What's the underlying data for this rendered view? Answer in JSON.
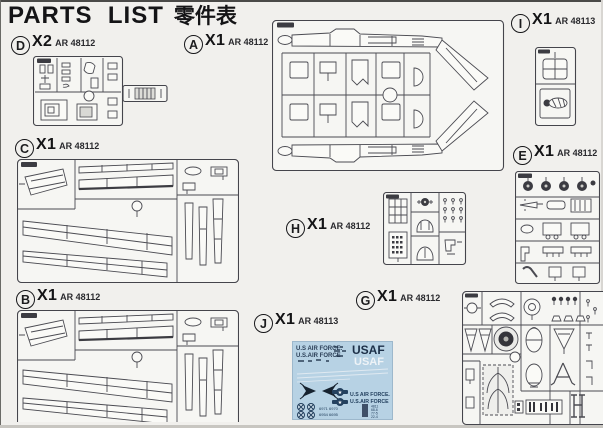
{
  "title": {
    "en": "PARTS  LIST",
    "zh": "零件表"
  },
  "sections": {
    "d": {
      "letter": "D",
      "qty": "X2",
      "code": "AR 48112"
    },
    "a": {
      "letter": "A",
      "qty": "X1",
      "code": "AR 48112"
    },
    "i": {
      "letter": "I",
      "qty": "X1",
      "code": "AR 48113"
    },
    "c": {
      "letter": "C",
      "qty": "X1",
      "code": "AR 48112"
    },
    "e": {
      "letter": "E",
      "qty": "X1",
      "code": "AR 48112"
    },
    "h": {
      "letter": "H",
      "qty": "X1",
      "code": "AR 48112"
    },
    "b": {
      "letter": "B",
      "qty": "X1",
      "code": "AR 48112"
    },
    "g": {
      "letter": "G",
      "qty": "X1",
      "code": "AR 48112"
    },
    "j": {
      "letter": "J",
      "qty": "X1",
      "code": "AR 48113"
    }
  },
  "decal": {
    "line1": "U.S AIR FORCE.",
    "line2": "U.S.AIR FORCE",
    "usaf_large": "USAF",
    "usaf_white": "USAF",
    "right_line1": "U.S AIR FORCE.",
    "right_line2": "U.S.AIR FORCE",
    "serial_left": "6971 6970",
    "serial_mid": "6954 6695",
    "numbers": [
      "4811",
      "68-6",
      "77-5",
      "22-4"
    ],
    "star": "★"
  },
  "colors": {
    "page_bg": "#f1f0ed",
    "line_art": "#4b4b52",
    "decal_bg": "#b7d2e4",
    "decal_navy": "#24415f"
  }
}
